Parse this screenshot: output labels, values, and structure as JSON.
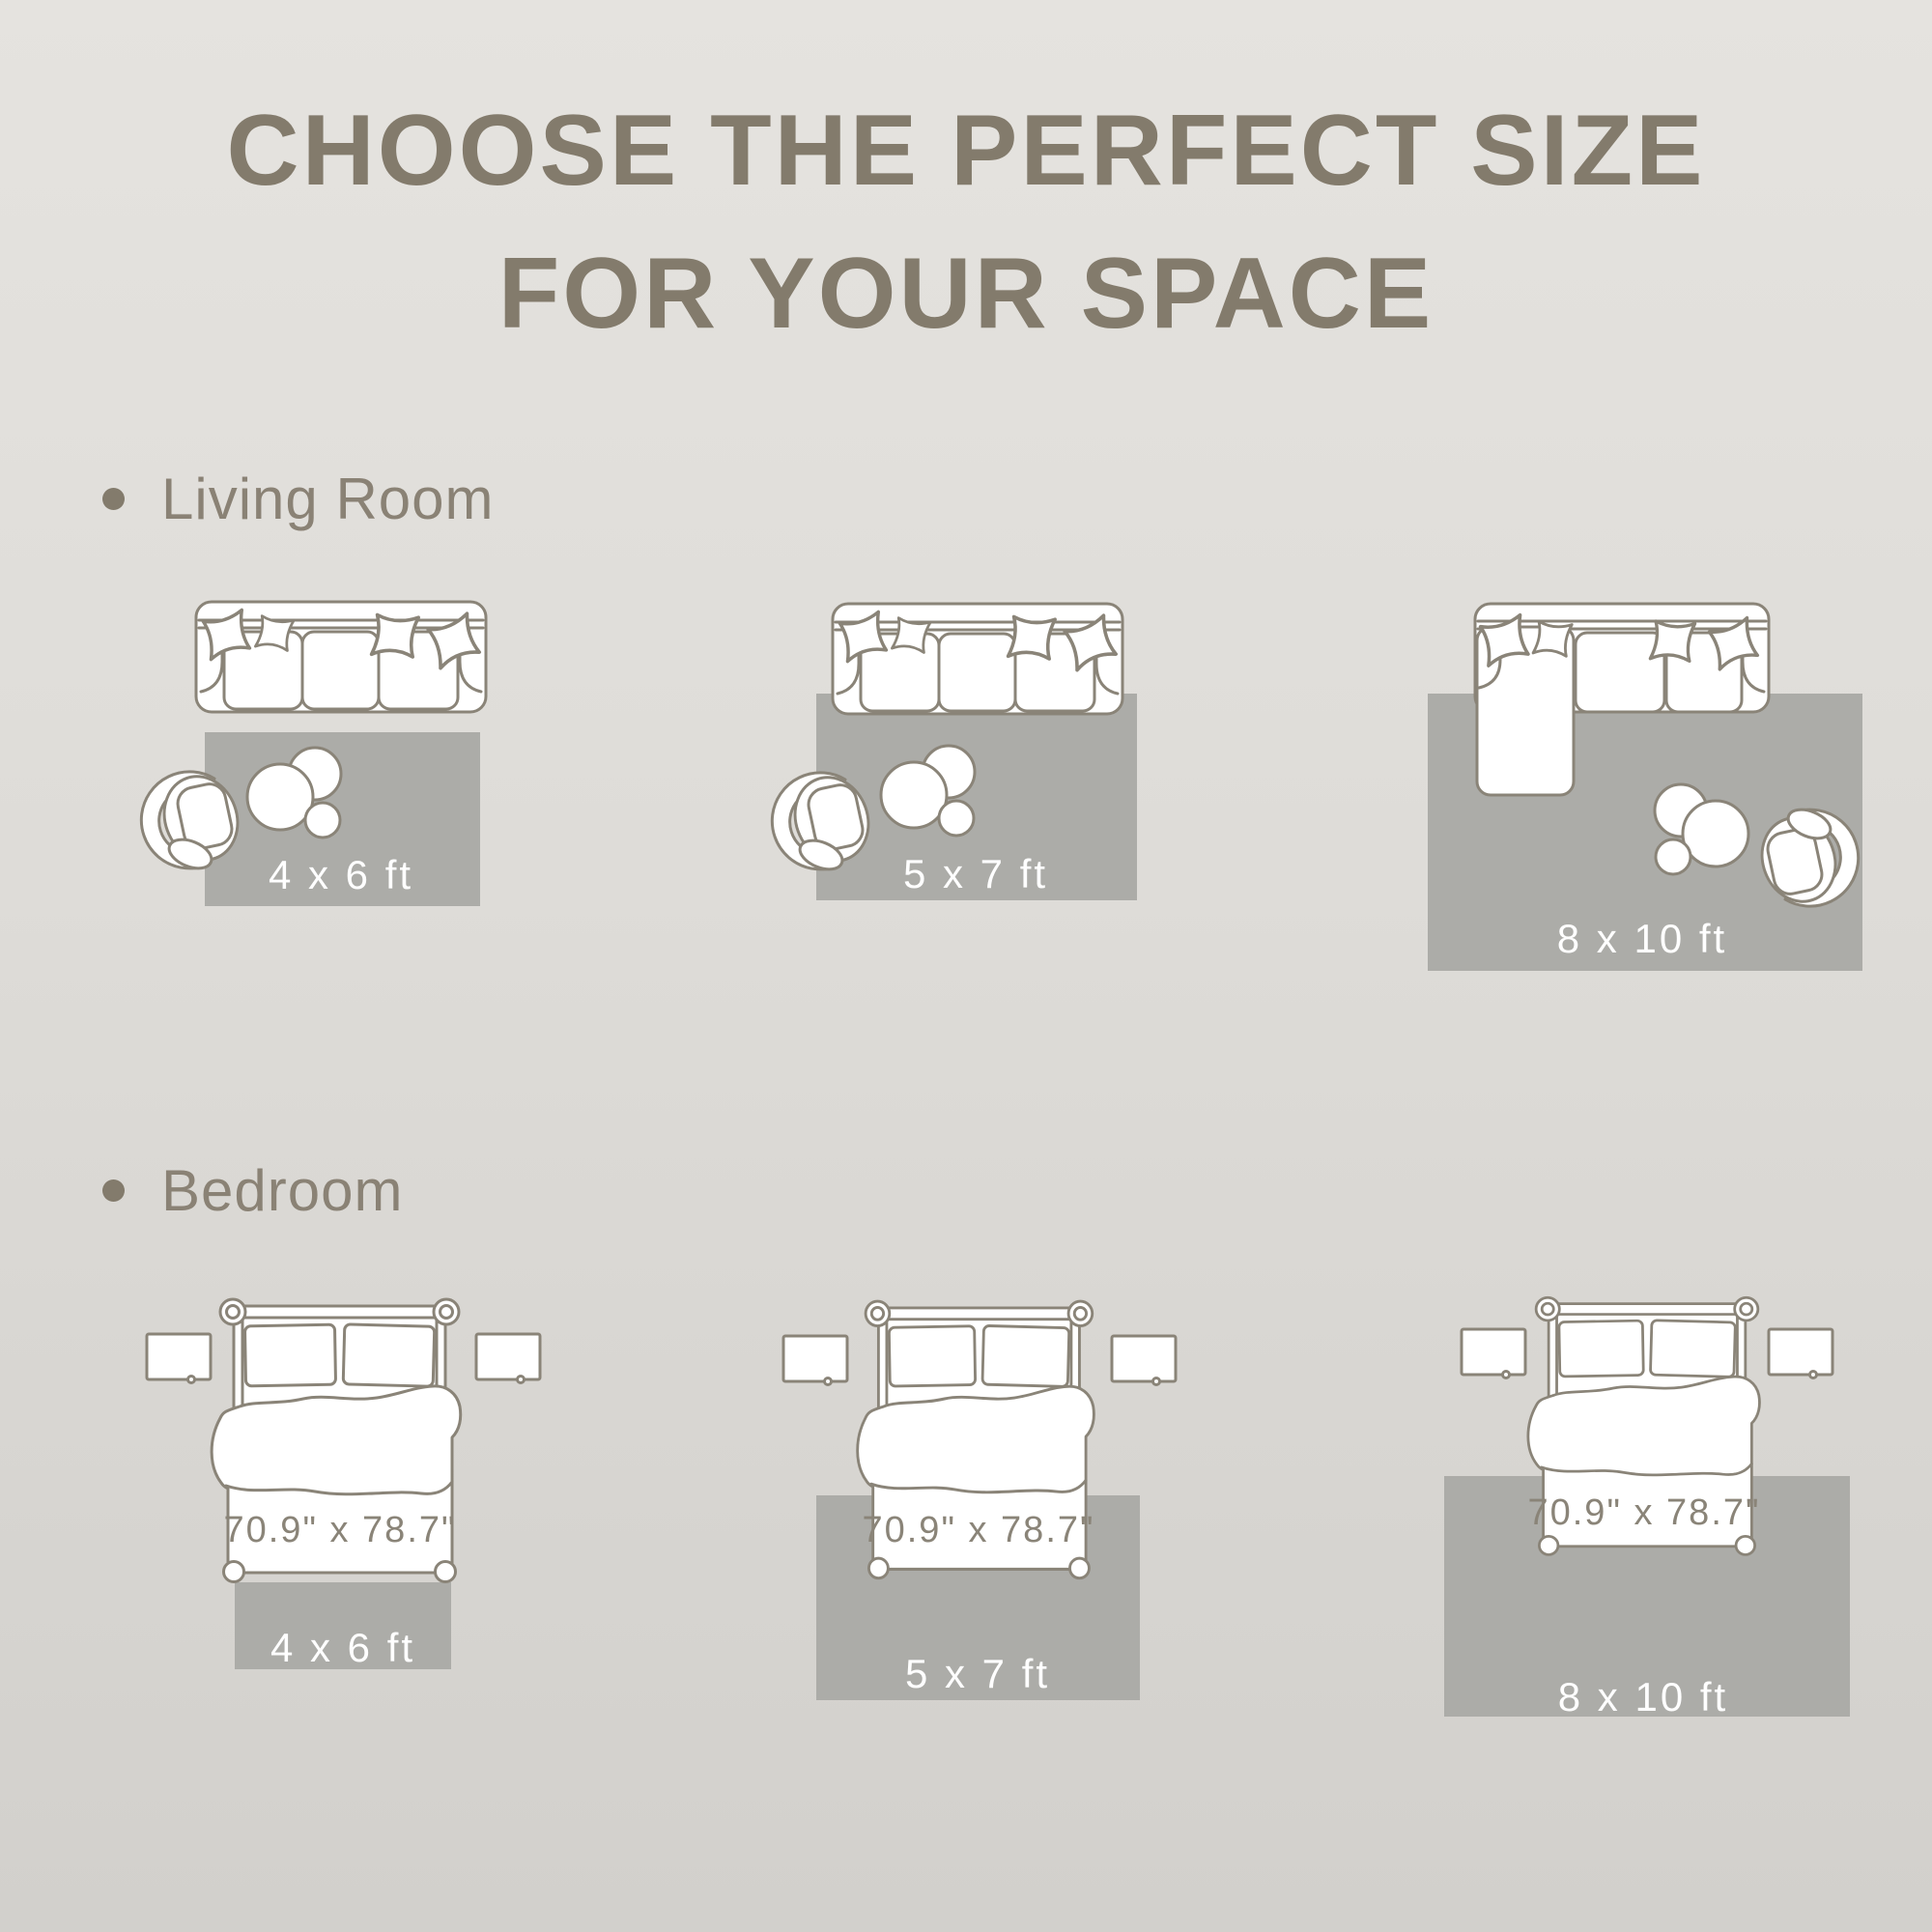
{
  "title": {
    "line1": "CHOOSE THE PERFECT SIZE",
    "line2": "FOR YOUR SPACE"
  },
  "sections": [
    {
      "label": "Living Room",
      "layouts": [
        {
          "rug_size": "4 x 6 ft"
        },
        {
          "rug_size": "5 x 7 ft"
        },
        {
          "rug_size": "8 x 10 ft"
        }
      ]
    },
    {
      "label": "Bedroom",
      "layouts": [
        {
          "rug_size": "4 x 6 ft",
          "bed_size": "70.9\" x 78.7\""
        },
        {
          "rug_size": "5 x 7 ft",
          "bed_size": "70.9\" x 78.7\""
        },
        {
          "rug_size": "8 x 10 ft",
          "bed_size": "70.9\" x 78.7\""
        }
      ]
    }
  ],
  "colors": {
    "background_top": "#E5E3DF",
    "background_mid": "#DEDCD8",
    "background_bottom": "#D2D0CC",
    "title_text": "#837B6C",
    "section_text": "#8A8275",
    "furniture_outline": "#8A8478",
    "furniture_fill": "#FFFFFF",
    "rug_fill": "#ACACA8",
    "rug_label_text": "#FFFFFF",
    "bed_size_text": "#8A8478"
  }
}
